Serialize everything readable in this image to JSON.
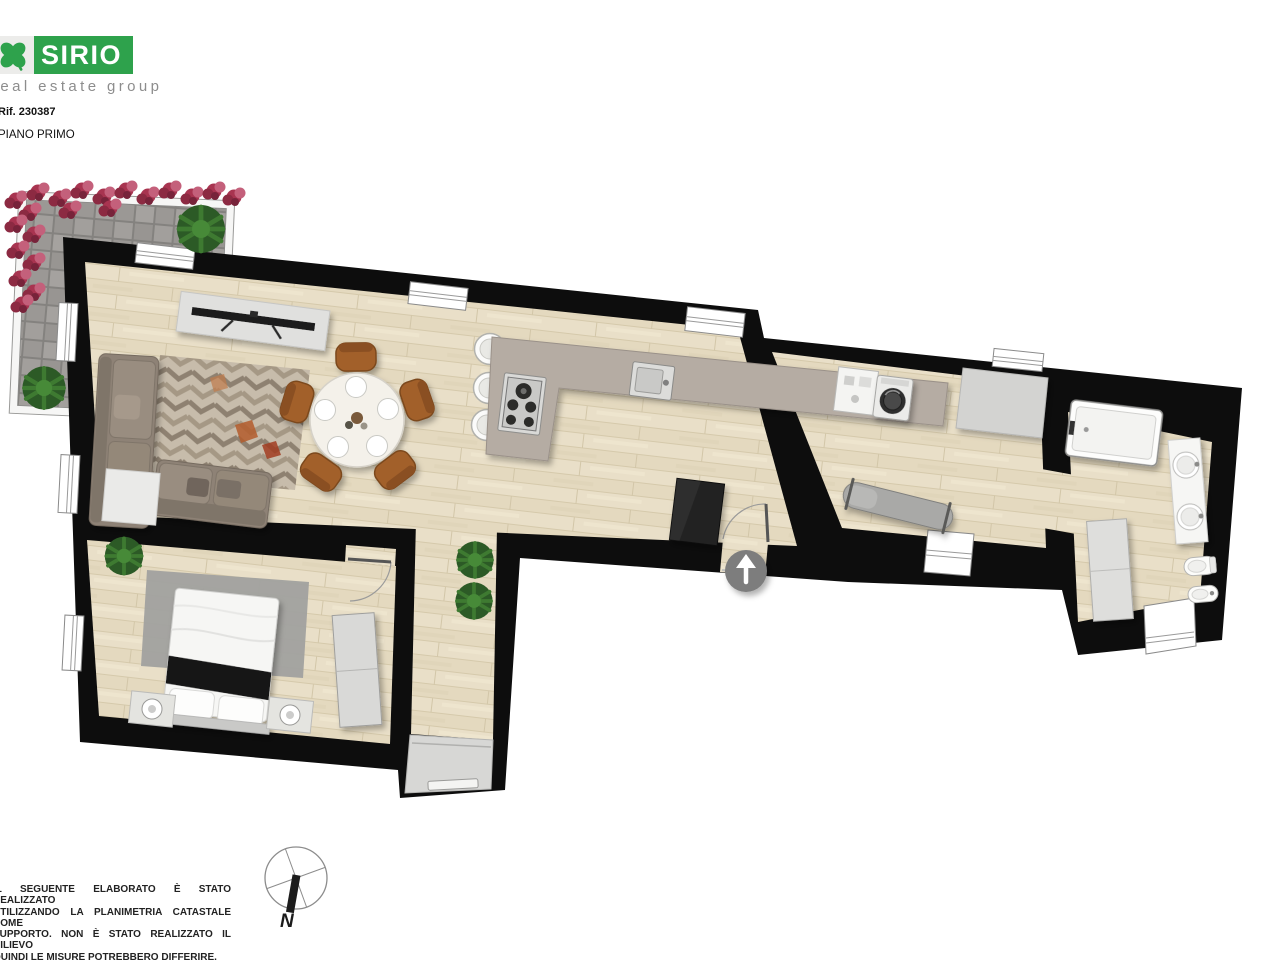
{
  "branding": {
    "logo_text": "SIRIO",
    "tagline": "real estate group",
    "brand_green": "#2ea24c",
    "clover_icon": "four-leaf-clover"
  },
  "header": {
    "reference": "Rif. 230387",
    "floor_label": "PIANO PRIMO"
  },
  "compass": {
    "north_label": "N",
    "orientation": "north-points-down"
  },
  "disclaimer": {
    "lines": [
      "IL SEGUENTE ELABORATO È STATO REALIZZATO",
      "UTILIZZANDO LA PLANIMETRIA CATASTALE COME",
      "SUPPORTO. NON È STATO REALIZZATO IL RILIEVO",
      "QUINDI LE MISURE POTREBBERO DIFFERIRE."
    ]
  },
  "floorplan": {
    "colors": {
      "wall": "#0d0d0d",
      "floor_wood": "#e8dec6",
      "kitchen_counter": "#b5aca3",
      "terrace_paver": "#9b9896",
      "entrance_marker": "#7d7d7d",
      "bedroom_rug": "#a1a19f"
    },
    "entrance": {
      "marker": "up-arrow-in-circle"
    },
    "rooms": [
      {
        "name": "terrazzo",
        "items": [
          "pavimentazione autobloccanti",
          "fioriere",
          "piante"
        ]
      },
      {
        "name": "soggiorno-pranzo",
        "items": [
          "divano angolare",
          "tavolino",
          "mobile tv",
          "tappeto geometrico",
          "tavolo rotondo con 5 sedie"
        ]
      },
      {
        "name": "cucina",
        "items": [
          "bancone a L",
          "piano cottura",
          "lavello",
          "3 sgabelli",
          "mobile scuro"
        ]
      },
      {
        "name": "camera da letto",
        "items": [
          "letto matrimoniale",
          "2 comodini",
          "armadio",
          "tappeto",
          "pianta"
        ]
      },
      {
        "name": "lavanderia",
        "items": [
          "lavatrice",
          "mobile",
          "piano di appoggio",
          "asse da stiro"
        ]
      },
      {
        "name": "bagno",
        "items": [
          "piatto doccia",
          "doppio lavabo",
          "wc",
          "bidet",
          "colonna"
        ]
      }
    ]
  }
}
